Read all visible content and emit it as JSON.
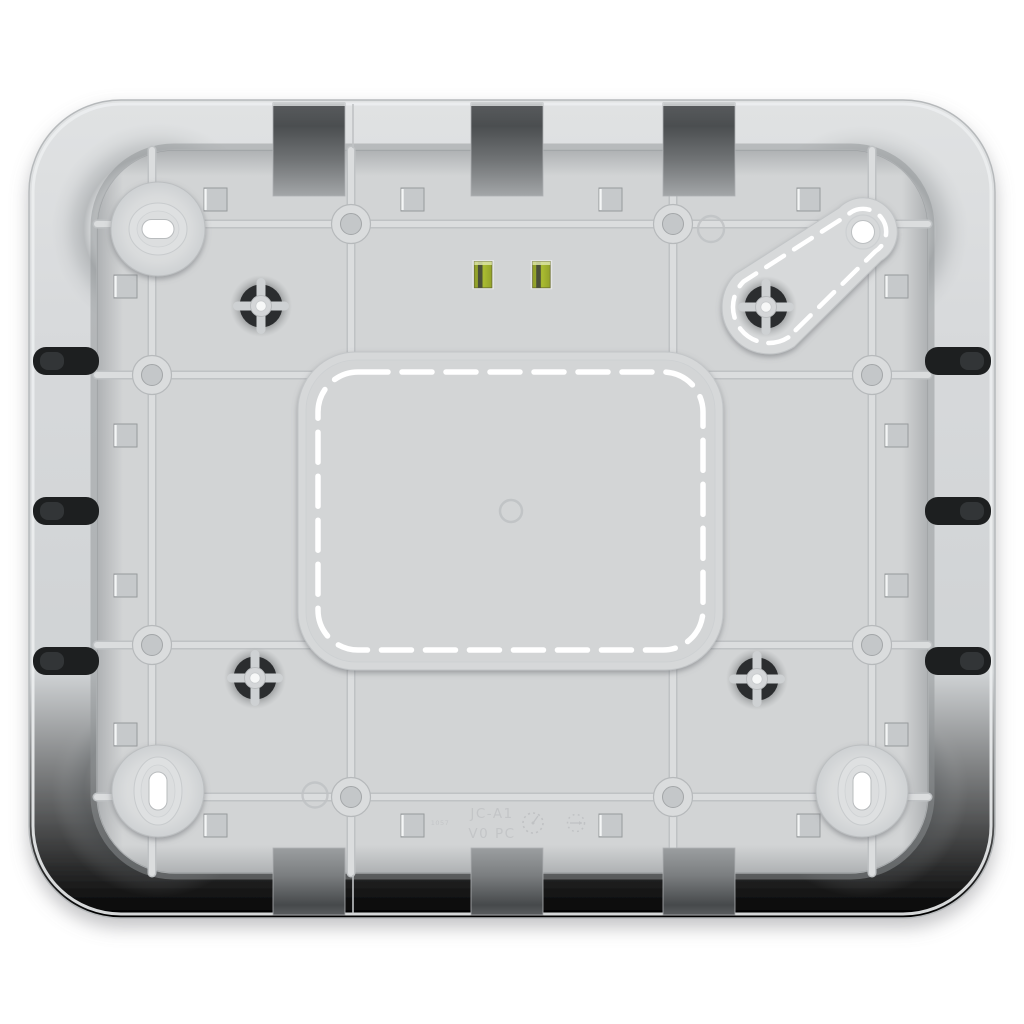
{
  "scene": {
    "description": "Bottom view 3D render of a light gray plastic wall-mount enclosure base plate",
    "background_color": "#ffffff",
    "body_color": "#d2d4d5",
    "accent_green": "#a4b52e",
    "slot_dark": "#1d1f20",
    "dash_white": "#ffffff"
  },
  "markings": {
    "model": "JC-A1",
    "material": "V0 PC",
    "mold_code": "1057"
  },
  "features": {
    "keyhole_mounts": 3,
    "teardrop_mount_holes": 1,
    "screw_bosses": 4,
    "green_windows": 2,
    "wall_notches_top": 3,
    "wall_notches_bottom": 3,
    "cable_slots_left": 3,
    "cable_slots_right": 3,
    "square_holes": 16,
    "rib_ring_holes": 8,
    "date_wheels": 2
  }
}
